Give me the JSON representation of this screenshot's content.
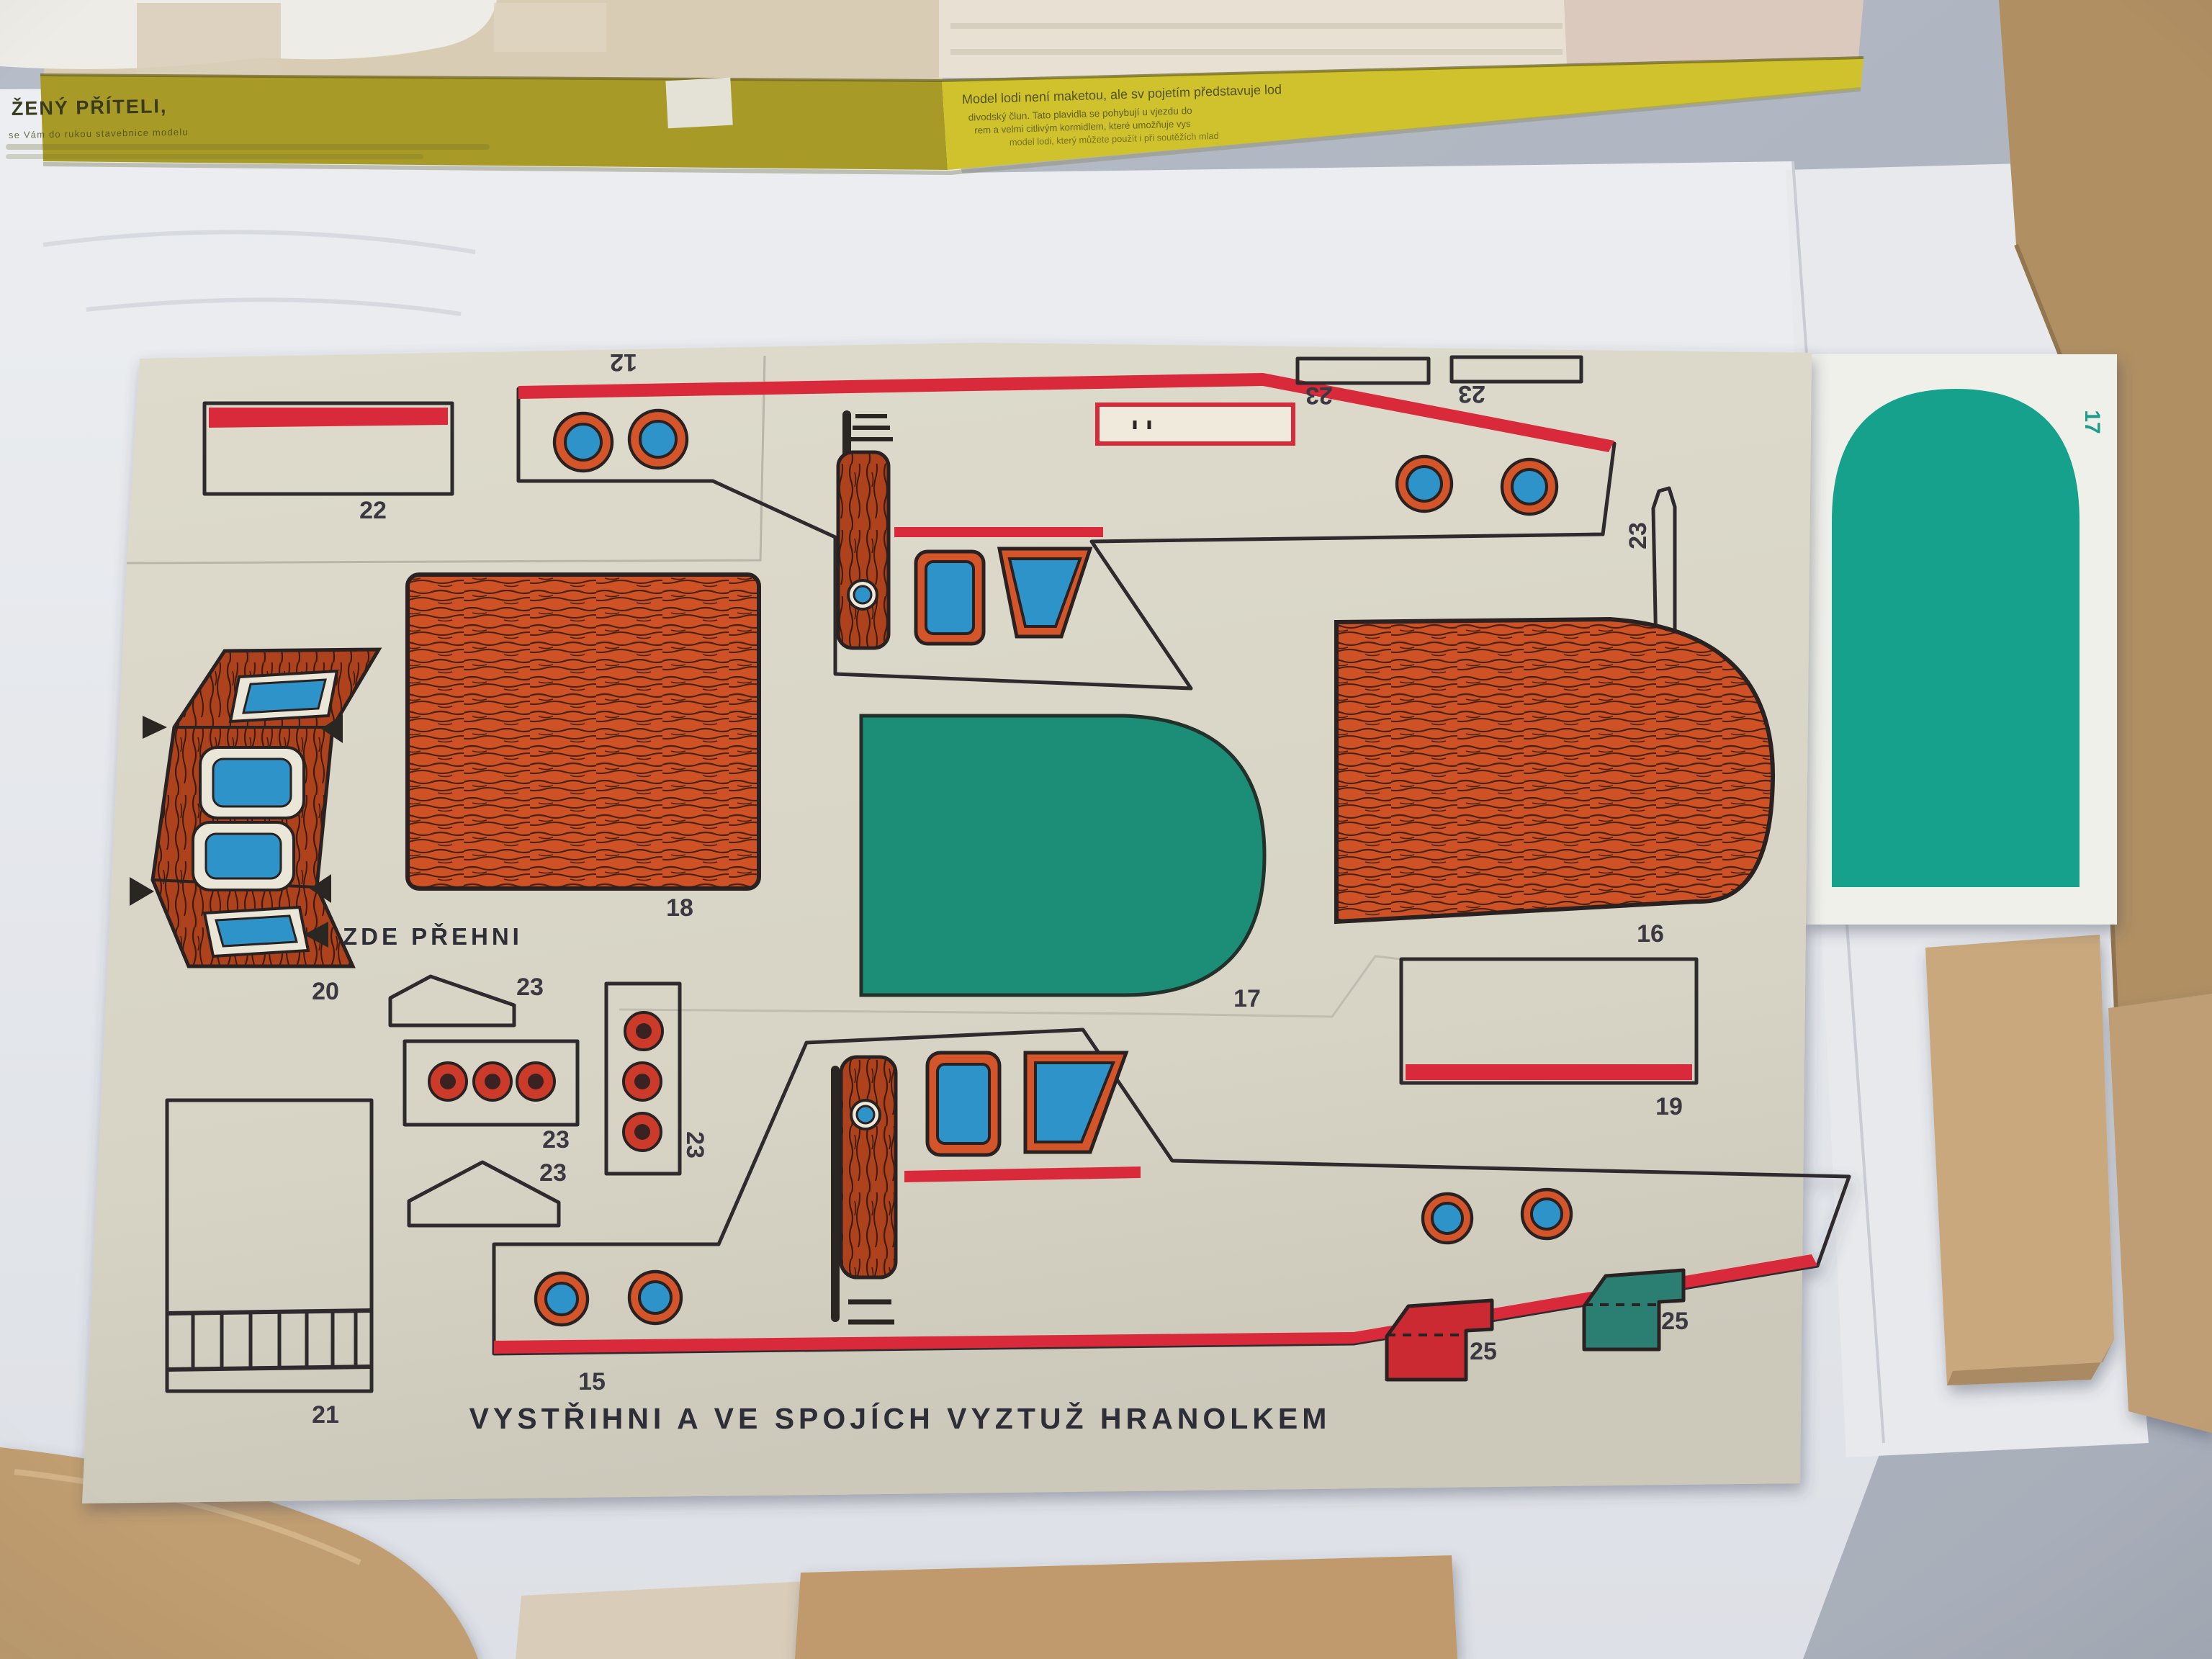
{
  "box": {
    "greeting": "ŽENÝ PŘÍTELI,",
    "small_left": "se Vám do rukou stavebnice modelu",
    "right_1": "Model lodi není maketou, ale sv      pojetím představuje lod",
    "right_2": "divodský člun. Tato plavidla se pohybují u vjezdu do",
    "right_3": "rem a velmi citlivým kormidlem, které umožňuje vys",
    "right_4": "model lodi, který můžete použít i při soutěžích mlad"
  },
  "labels": {
    "part12": "12",
    "part15": "15",
    "part16": "16",
    "part17": "17",
    "part18": "18",
    "part19": "19",
    "part20": "20",
    "part21": "21",
    "part22": "22",
    "part23": "23",
    "part25": "25",
    "card17": "17",
    "fold_note": "ZDE PŘEHNI",
    "caption": "VYSTŘIHNI A VE SPOJÍCH VYZTUŽ HRANOLKEM"
  },
  "colors": {
    "table": "#b2b8c2",
    "paper": "#e9ebee",
    "board": "#d9d6c8",
    "red": "#d9293a",
    "orange_frame": "#d4552a",
    "wood": "#cf5126",
    "wood_dark": "#ad421f",
    "window_blue": "#2e93c8",
    "teal_part": "#1f8e77",
    "teal_card": "#16a18c",
    "teal_flag": "#2b7f72",
    "box_yellow_left": "#a89a26",
    "box_yellow_right": "#cfc22c",
    "kraft": "#b08f63",
    "plank": "#c9a87d"
  }
}
